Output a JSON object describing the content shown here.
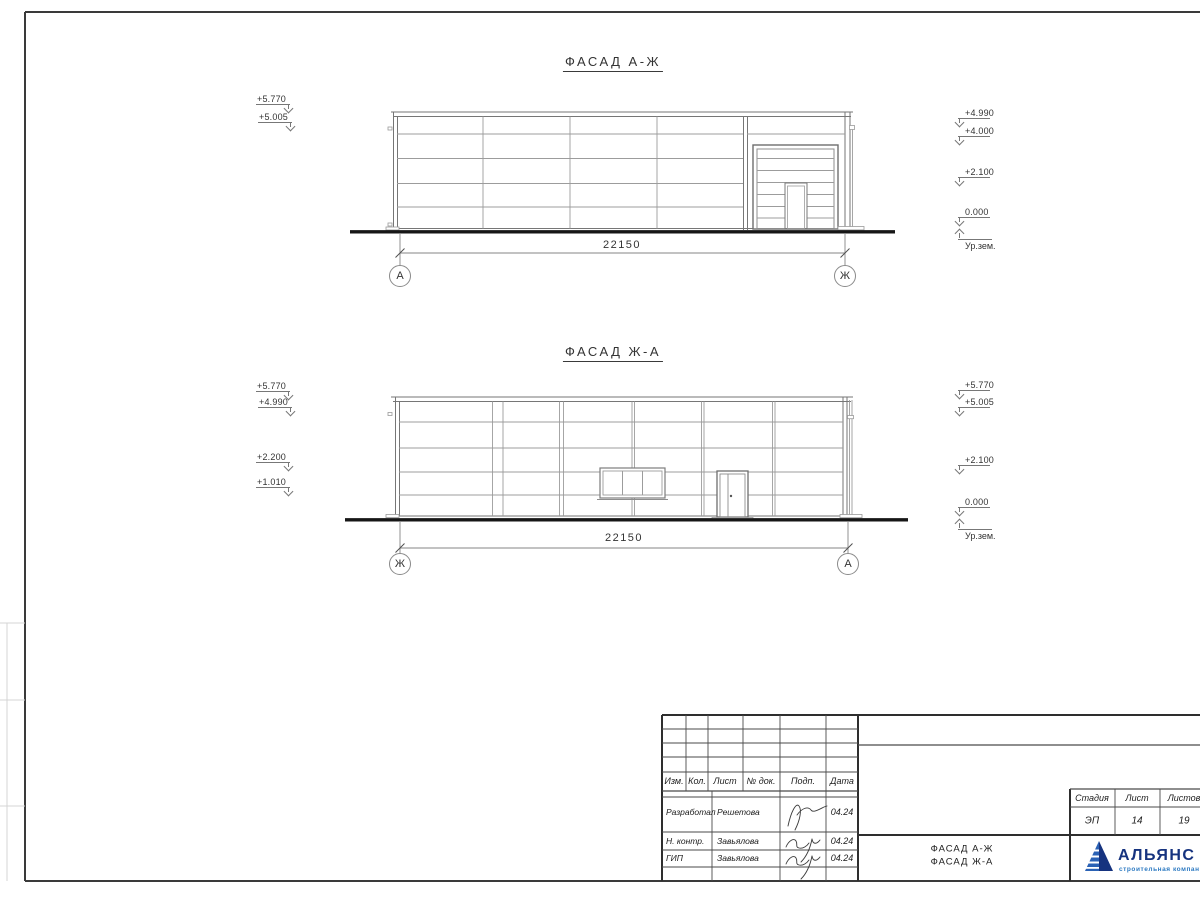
{
  "facades": [
    {
      "title": "ФАСАД А-Ж",
      "dimension_label": "22150",
      "axis_left": "А",
      "axis_right": "Ж",
      "left_marks": [
        "+5.770",
        "+5.005"
      ],
      "right_marks": [
        "+4.990",
        "+4.000",
        "+2.100",
        "0.000"
      ],
      "ground_level_label": "Ур.зем."
    },
    {
      "title": "ФАСАД Ж-А",
      "dimension_label": "22150",
      "axis_left": "Ж",
      "axis_right": "А",
      "left_marks": [
        "+5.770",
        "+4.990",
        "+2.200",
        "+1.010"
      ],
      "right_marks": [
        "+5.770",
        "+5.005",
        "+2.100",
        "0.000"
      ],
      "ground_level_label": "Ур.зем."
    }
  ],
  "title_block": {
    "revision_headers": [
      "Изм.",
      "Кол.",
      "Лист",
      "№ док.",
      "Подп.",
      "Дата"
    ],
    "signature_rows": [
      {
        "role": "Разработал",
        "name": "Решетова",
        "date": "04.24"
      },
      {
        "role": "Н. контр.",
        "name": "Завьялова",
        "date": "04.24"
      },
      {
        "role": "ГИП",
        "name": "Завьялова",
        "date": "04.24"
      }
    ],
    "drawing_name_line1": "ФАСАД А-Ж",
    "drawing_name_line2": "ФАСАД Ж-А",
    "stage_headers": [
      "Стадия",
      "Лист",
      "Листов"
    ],
    "stage_value": "ЭП",
    "sheet_value": "14",
    "sheets_value": "19",
    "logo": {
      "company": "АЛЬЯНС",
      "tagline": "строительная компания",
      "primary_color": "#16337f",
      "tagline_color": "#2d7ac2"
    }
  }
}
